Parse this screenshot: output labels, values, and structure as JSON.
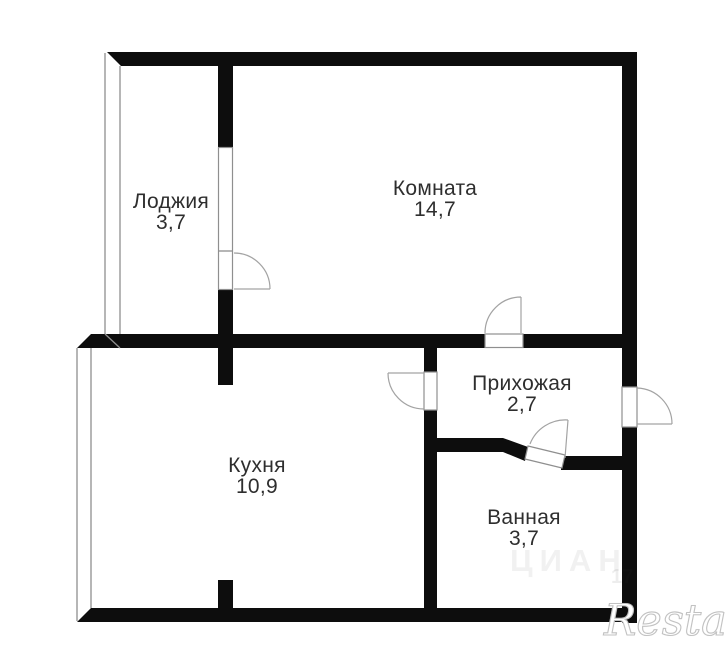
{
  "plan": {
    "rooms": {
      "loggia": {
        "name": "Лоджия",
        "area": "3,7"
      },
      "room": {
        "name": "Комната",
        "area": "14,7"
      },
      "kitchen": {
        "name": "Кухня",
        "area": "10,9"
      },
      "hallway": {
        "name": "Прихожая",
        "area": "2,7"
      },
      "bathroom": {
        "name": "Ванная",
        "area": "3,7"
      }
    },
    "watermarks": {
      "brand": "Restate",
      "portal": "ЦИАН",
      "code": "17"
    },
    "colors": {
      "wall": "#0d0d0d",
      "thin_line": "#8f8f8f",
      "label_text": "#2e2e2e",
      "background": "#ffffff"
    }
  }
}
